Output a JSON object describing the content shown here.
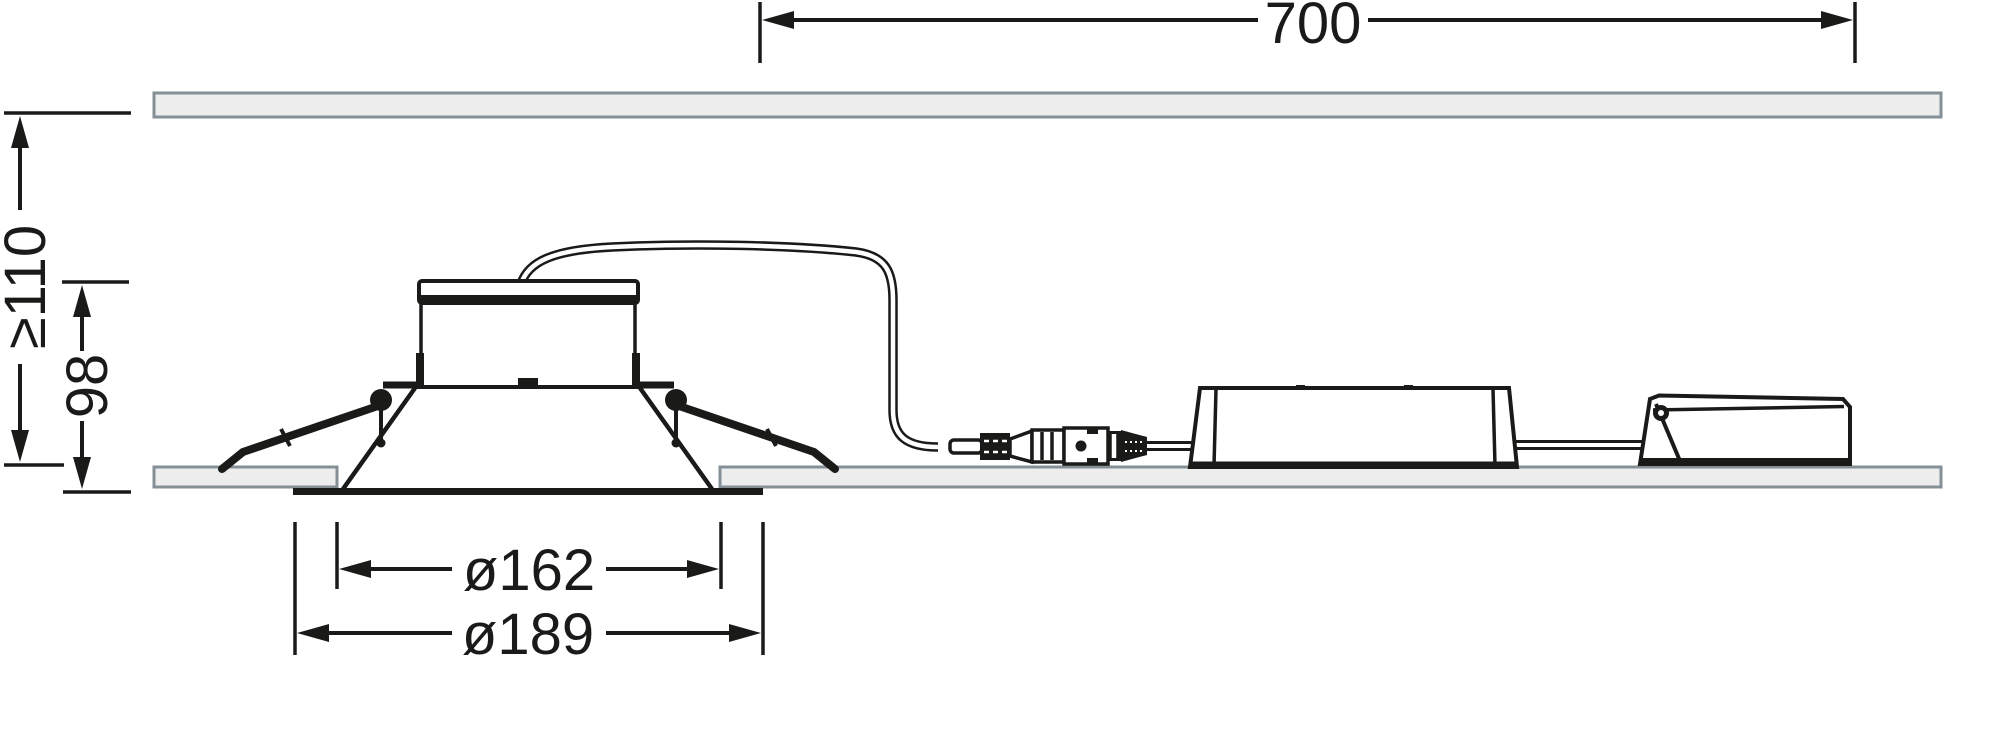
{
  "colors": {
    "background": "#ffffff",
    "line": "#1a1a18",
    "panel_fill": "#ededee",
    "panel_border": "#848f96"
  },
  "dimensions": {
    "span_700": {
      "label": "700",
      "value": 700,
      "orientation": "horizontal"
    },
    "min_recess_depth": {
      "label": "≥110",
      "value": 110,
      "orientation": "vertical"
    },
    "fixture_height": {
      "label": "98",
      "value": 98,
      "orientation": "vertical"
    },
    "cutout_diameter": {
      "label": "ø162",
      "value": 162,
      "orientation": "horizontal"
    },
    "flange_diameter": {
      "label": "ø189",
      "value": 189,
      "orientation": "horizontal"
    }
  }
}
